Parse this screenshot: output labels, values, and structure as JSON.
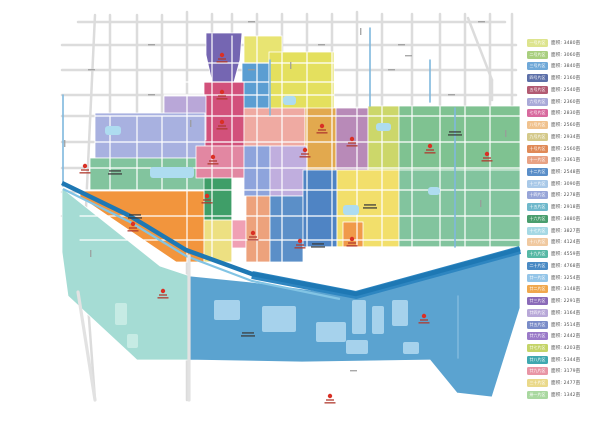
{
  "legend": {
    "area_prefix": "面积:",
    "unit": "亩",
    "items": [
      {
        "name": "一号片区",
        "color": "#dde48e",
        "area": "3480"
      },
      {
        "name": "二号片区",
        "color": "#a9cf7f",
        "area": "3060"
      },
      {
        "name": "三号片区",
        "color": "#6fa8d8",
        "area": "3840"
      },
      {
        "name": "四号片区",
        "color": "#5c6fa8",
        "area": "2160"
      },
      {
        "name": "五号片区",
        "color": "#b25a72",
        "area": "2540"
      },
      {
        "name": "六号片区",
        "color": "#a9a9d8",
        "area": "2360"
      },
      {
        "name": "七号片区",
        "color": "#d86a9e",
        "area": "2830"
      },
      {
        "name": "八号片区",
        "color": "#f0c28e",
        "area": "2560"
      },
      {
        "name": "九号片区",
        "color": "#d4c98a",
        "area": "2934"
      },
      {
        "name": "十号片区",
        "color": "#e08a58",
        "area": "2560"
      },
      {
        "name": "十一片区",
        "color": "#e8a284",
        "area": "3361"
      },
      {
        "name": "十二片区",
        "color": "#5a8ec8",
        "area": "2548"
      },
      {
        "name": "十三片区",
        "color": "#a9c9e8",
        "area": "3090"
      },
      {
        "name": "十四片区",
        "color": "#97a5d8",
        "area": "2278"
      },
      {
        "name": "十五片区",
        "color": "#6fb8cb",
        "area": "2918"
      },
      {
        "name": "十六片区",
        "color": "#4a9e6e",
        "area": "3880"
      },
      {
        "name": "十七片区",
        "color": "#a5d8e4",
        "area": "3827"
      },
      {
        "name": "十八片区",
        "color": "#f0c9a0",
        "area": "4124"
      },
      {
        "name": "十九片区",
        "color": "#57b8a5",
        "area": "4559"
      },
      {
        "name": "二十片区",
        "color": "#4a8ac4",
        "area": "4768"
      },
      {
        "name": "廿一片区",
        "color": "#94c5e8",
        "area": "3254"
      },
      {
        "name": "廿二片区",
        "color": "#f0a84e",
        "area": "3148"
      },
      {
        "name": "廿三片区",
        "color": "#8a6ab8",
        "area": "2291"
      },
      {
        "name": "廿四片区",
        "color": "#b8a8d8",
        "area": "3164"
      },
      {
        "name": "廿五片区",
        "color": "#7a8cc8",
        "area": "3514"
      },
      {
        "name": "廿六片区",
        "color": "#9a7ac8",
        "area": "2442"
      },
      {
        "name": "廿七片区",
        "color": "#c4d468",
        "area": "4203"
      },
      {
        "name": "廿八片区",
        "color": "#3fa8b0",
        "area": "5344"
      },
      {
        "name": "廿九片区",
        "color": "#e895a5",
        "area": "3179"
      },
      {
        "name": "三十片区",
        "color": "#ead98a",
        "area": "2477"
      },
      {
        "name": "卅一片区",
        "color": "#a9d8a0",
        "area": "1342"
      }
    ]
  },
  "map": {
    "background": "#ffffff",
    "road_color": "#dcdcdc",
    "road_overlay_color": "#e2e2e2",
    "white_road_color": "#ffffff",
    "canal_color": "#7fb8dd",
    "river_color": "#1e78b4",
    "river_band_color": "#2e86c1",
    "river_light_color": "#82c4e4",
    "pond_color": "#aedcf0",
    "water_patch_color": "#a6d2ec",
    "teal_patch_color": "#c6ebe4",
    "marker_color": "#d93025",
    "marker_text_color": "#b03a2e",
    "zone_label_color": "#3a3a3a",
    "road_label_color": "#9a9a9a",
    "zones": [
      {
        "name": "purple-north",
        "color": "#7566b2",
        "shape": "poly",
        "points": "206,33 242,33 240,60 234,82 212,82 206,55"
      },
      {
        "name": "yellow-north",
        "color": "#e8e472",
        "shape": "rect",
        "x": 244,
        "y": 36,
        "w": 38,
        "h": 27
      },
      {
        "name": "blue-north",
        "color": "#5b9ed2",
        "shape": "rect",
        "x": 242,
        "y": 63,
        "w": 27,
        "h": 49
      },
      {
        "name": "crimson-north",
        "color": "#d2517b",
        "shape": "rect",
        "x": 204,
        "y": 82,
        "w": 40,
        "h": 64
      },
      {
        "name": "yellow-northeast",
        "color": "#e4e05e",
        "shape": "rect",
        "x": 269,
        "y": 52,
        "w": 65,
        "h": 63
      },
      {
        "name": "lilac-west",
        "color": "#b9a7d8",
        "shape": "rect",
        "x": 164,
        "y": 96,
        "w": 42,
        "h": 44
      },
      {
        "name": "salmon-center",
        "color": "#efaaa2",
        "shape": "rect",
        "x": 244,
        "y": 108,
        "w": 61,
        "h": 38
      },
      {
        "name": "amber-center",
        "color": "#e2a94e",
        "shape": "rect",
        "x": 305,
        "y": 108,
        "w": 31,
        "h": 62
      },
      {
        "name": "mauve-center",
        "color": "#b88ab8",
        "shape": "rect",
        "x": 336,
        "y": 108,
        "w": 32,
        "h": 62
      },
      {
        "name": "yellowgreen-center",
        "color": "#ccd76a",
        "shape": "rect",
        "x": 368,
        "y": 106,
        "w": 31,
        "h": 64
      },
      {
        "name": "green-east",
        "color": "#7fc291",
        "shape": "rect",
        "x": 399,
        "y": 106,
        "w": 121,
        "h": 64
      },
      {
        "name": "periwinkle-west",
        "color": "#a8b1e0",
        "shape": "rect",
        "x": 95,
        "y": 113,
        "w": 110,
        "h": 45
      },
      {
        "name": "green-west",
        "color": "#82c49e",
        "shape": "rect",
        "x": 90,
        "y": 158,
        "w": 120,
        "h": 32
      },
      {
        "name": "rose-mid",
        "color": "#e287a2",
        "shape": "rect",
        "x": 196,
        "y": 146,
        "w": 48,
        "h": 32
      },
      {
        "name": "periwinkle-mid",
        "color": "#8ea4dc",
        "shape": "rect",
        "x": 244,
        "y": 146,
        "w": 26,
        "h": 50
      },
      {
        "name": "lilac-mid",
        "color": "#c0aede",
        "shape": "rect",
        "x": 270,
        "y": 146,
        "w": 37,
        "h": 50
      },
      {
        "name": "darkgreen-mid",
        "color": "#3f9e68",
        "shape": "rect",
        "x": 204,
        "y": 178,
        "w": 28,
        "h": 42
      },
      {
        "name": "orange-west",
        "color": "#f2953d",
        "shape": "poly",
        "points": "80,191 204,191 204,262 176,262 80,197"
      },
      {
        "name": "yellow-mid",
        "color": "#ede082",
        "shape": "rect",
        "x": 204,
        "y": 220,
        "w": 28,
        "h": 42
      },
      {
        "name": "pink-mid",
        "color": "#f0a0b4",
        "shape": "rect",
        "x": 232,
        "y": 220,
        "w": 14,
        "h": 28
      },
      {
        "name": "salmon-mid",
        "color": "#eda27c",
        "shape": "rect",
        "x": 246,
        "y": 196,
        "w": 24,
        "h": 66
      },
      {
        "name": "blue-mid",
        "color": "#5b8fc8",
        "shape": "rect",
        "x": 270,
        "y": 196,
        "w": 33,
        "h": 66
      },
      {
        "name": "blue-center",
        "color": "#4f84c4",
        "shape": "rect",
        "x": 303,
        "y": 170,
        "w": 34,
        "h": 77
      },
      {
        "name": "yellow-southeast",
        "color": "#f2df6b",
        "shape": "rect",
        "x": 337,
        "y": 170,
        "w": 62,
        "h": 77
      },
      {
        "name": "orange-sub",
        "color": "#f09a4a",
        "shape": "rect",
        "x": 343,
        "y": 222,
        "w": 20,
        "h": 25
      },
      {
        "name": "green-southeast",
        "color": "#82c49e",
        "shape": "rect",
        "x": 399,
        "y": 170,
        "w": 121,
        "h": 77
      },
      {
        "name": "teal-south",
        "color": "#a5dcd4",
        "shape": "poly",
        "points": "62,188 160,266 190,276 190,360 137,360 68,296 62,252"
      },
      {
        "name": "water-south",
        "color": "#5ba3d0",
        "shape": "poly",
        "points": "190,276 250,282 356,296 440,272 520,249 520,308 492,397 457,393 430,360 302,362 190,360"
      }
    ],
    "roads_gray": [
      [
        95,
        15,
        84,
        250
      ],
      [
        84,
        250,
        95,
        400
      ],
      [
        110,
        15,
        110,
        192
      ],
      [
        137,
        15,
        137,
        116
      ],
      [
        162,
        15,
        162,
        116
      ],
      [
        187,
        12,
        187,
        400
      ],
      [
        212,
        14,
        212,
        34
      ],
      [
        232,
        14,
        232,
        64
      ],
      [
        257,
        14,
        257,
        53
      ],
      [
        282,
        14,
        282,
        53
      ],
      [
        307,
        14,
        307,
        107
      ],
      [
        332,
        14,
        332,
        53
      ],
      [
        357,
        12,
        357,
        107
      ],
      [
        382,
        14,
        382,
        107
      ],
      [
        412,
        14,
        412,
        107
      ],
      [
        440,
        14,
        440,
        107
      ],
      [
        465,
        14,
        465,
        107
      ],
      [
        490,
        14,
        490,
        107
      ],
      [
        512,
        14,
        512,
        250
      ],
      [
        468,
        18,
        492,
        80
      ],
      [
        492,
        80,
        492,
        100
      ],
      [
        78,
        22,
        505,
        22
      ],
      [
        62,
        45,
        516,
        45
      ],
      [
        62,
        70,
        516,
        70
      ],
      [
        62,
        95,
        516,
        95
      ],
      [
        62,
        116,
        96,
        116
      ],
      [
        62,
        142,
        94,
        142
      ],
      [
        62,
        168,
        84,
        168
      ],
      [
        62,
        192,
        80,
        192
      ],
      [
        62,
        216,
        80,
        216
      ]
    ],
    "roads_white": [
      [
        110,
        116,
        110,
        190
      ],
      [
        137,
        116,
        137,
        190
      ],
      [
        162,
        116,
        162,
        190
      ],
      [
        187,
        96,
        187,
        262
      ],
      [
        212,
        34,
        212,
        262
      ],
      [
        232,
        36,
        232,
        262
      ],
      [
        257,
        36,
        257,
        262
      ],
      [
        282,
        53,
        282,
        262
      ],
      [
        307,
        53,
        307,
        262
      ],
      [
        332,
        53,
        332,
        247
      ],
      [
        357,
        107,
        357,
        247
      ],
      [
        382,
        107,
        382,
        247
      ],
      [
        412,
        107,
        412,
        247
      ],
      [
        440,
        107,
        440,
        247
      ],
      [
        465,
        107,
        465,
        247
      ],
      [
        490,
        107,
        490,
        247
      ],
      [
        204,
        63,
        334,
        63
      ],
      [
        186,
        82,
        334,
        82
      ],
      [
        164,
        95,
        334,
        95
      ],
      [
        95,
        116,
        520,
        116
      ],
      [
        95,
        142,
        520,
        142
      ],
      [
        90,
        168,
        520,
        168
      ],
      [
        80,
        190,
        520,
        190
      ],
      [
        80,
        216,
        520,
        216
      ],
      [
        80,
        240,
        520,
        240
      ],
      [
        307,
        247,
        520,
        247
      ]
    ],
    "roads_overlay": [
      [
        189,
        256,
        189,
        400
      ],
      [
        78,
        292,
        95,
        400
      ]
    ],
    "canals": [
      [
        63,
        95,
        63,
        186
      ],
      [
        270,
        60,
        270,
        115
      ],
      [
        370,
        28,
        370,
        106
      ],
      [
        430,
        60,
        430,
        102
      ],
      [
        455,
        108,
        455,
        247
      ],
      [
        458,
        296,
        458,
        358
      ]
    ],
    "river_band_path": "M252,275 L356,295 L440,272 L520,250",
    "river_light_path": "M63,189 L130,222 L186,256 L252,281 L340,299",
    "river_main_path": "M62,183 L130,216 L186,250 L252,274 L356,294 L440,271 L520,249",
    "ponds": [
      [
        150,
        167,
        44,
        11
      ],
      [
        283,
        96,
        13,
        9
      ],
      [
        376,
        123,
        15,
        8
      ],
      [
        343,
        205,
        16,
        10
      ],
      [
        105,
        126,
        16,
        9
      ],
      [
        428,
        187,
        12,
        8
      ]
    ],
    "water_patches": [
      [
        316,
        322,
        30,
        20
      ],
      [
        352,
        300,
        14,
        34
      ],
      [
        372,
        306,
        12,
        28
      ],
      [
        392,
        300,
        16,
        26
      ],
      [
        346,
        340,
        22,
        14
      ],
      [
        403,
        342,
        16,
        12
      ],
      [
        262,
        306,
        34,
        26
      ],
      [
        214,
        300,
        26,
        20
      ]
    ],
    "teal_patches": [
      [
        115,
        303,
        12,
        22
      ],
      [
        127,
        334,
        11,
        14
      ]
    ],
    "markers": [
      {
        "x": 222,
        "y": 55
      },
      {
        "x": 222,
        "y": 92
      },
      {
        "x": 222,
        "y": 122
      },
      {
        "x": 213,
        "y": 157
      },
      {
        "x": 85,
        "y": 166
      },
      {
        "x": 133,
        "y": 224
      },
      {
        "x": 207,
        "y": 196
      },
      {
        "x": 253,
        "y": 233
      },
      {
        "x": 322,
        "y": 126
      },
      {
        "x": 305,
        "y": 150
      },
      {
        "x": 352,
        "y": 139
      },
      {
        "x": 430,
        "y": 146
      },
      {
        "x": 487,
        "y": 154
      },
      {
        "x": 300,
        "y": 241
      },
      {
        "x": 352,
        "y": 239
      },
      {
        "x": 424,
        "y": 316
      },
      {
        "x": 330,
        "y": 396
      },
      {
        "x": 163,
        "y": 291
      }
    ],
    "zone_labels": [
      {
        "x": 455,
        "y": 131
      },
      {
        "x": 370,
        "y": 204
      },
      {
        "x": 115,
        "y": 170
      },
      {
        "x": 248,
        "y": 332
      },
      {
        "x": 135,
        "y": 214
      },
      {
        "x": 318,
        "y": 243
      }
    ],
    "road_labels": [
      {
        "x": 148,
        "y": 44,
        "v": false
      },
      {
        "x": 248,
        "y": 21,
        "v": false
      },
      {
        "x": 318,
        "y": 44,
        "v": false
      },
      {
        "x": 398,
        "y": 44,
        "v": false
      },
      {
        "x": 478,
        "y": 21,
        "v": false
      },
      {
        "x": 88,
        "y": 69,
        "v": false
      },
      {
        "x": 248,
        "y": 69,
        "v": false
      },
      {
        "x": 388,
        "y": 69,
        "v": false
      },
      {
        "x": 448,
        "y": 94,
        "v": false
      },
      {
        "x": 148,
        "y": 94,
        "v": false
      },
      {
        "x": 405,
        "y": 55,
        "v": false
      },
      {
        "x": 64,
        "y": 140,
        "v": true
      },
      {
        "x": 190,
        "y": 120,
        "v": true
      },
      {
        "x": 290,
        "y": 62,
        "v": true
      },
      {
        "x": 360,
        "y": 28,
        "v": true
      },
      {
        "x": 505,
        "y": 130,
        "v": true
      },
      {
        "x": 90,
        "y": 250,
        "v": true
      },
      {
        "x": 480,
        "y": 200,
        "v": true
      },
      {
        "x": 350,
        "y": 370,
        "v": false
      }
    ]
  }
}
